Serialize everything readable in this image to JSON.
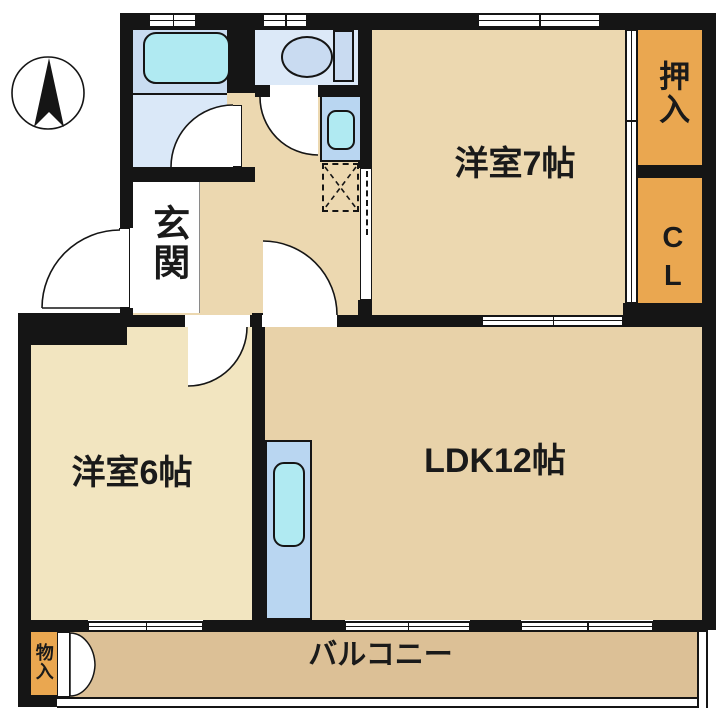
{
  "plan_title": "2LDK apartment floor plan",
  "rooms": {
    "western7": {
      "label": "洋室7帖"
    },
    "western6": {
      "label": "洋室6帖"
    },
    "ldk": {
      "label": "LDK12帖"
    },
    "balcony": {
      "label": "バルコニー"
    },
    "entrance": {
      "label": "玄関"
    },
    "oshiire": {
      "label": "押入"
    },
    "closet": {
      "label": "CL"
    },
    "storage": {
      "label": "物入"
    }
  },
  "icons": {
    "compass": "north-arrow"
  },
  "colors": {
    "wall": "#151515",
    "room_beige": "#ecd8b0",
    "room_cream": "#f2e5c0",
    "ldk_tan": "#e8d2a9",
    "balcony_tan": "#dcc096",
    "closet_orange": "#eaa750",
    "bath_blue": "#dae8f8",
    "bath_upper": "#c9dcf1",
    "toilet_blue": "#dce9f8",
    "toilet_fix": "#c9dbf1",
    "fixture_blue": "#b9d6f1",
    "water_cyan": "#b0eaf2"
  }
}
